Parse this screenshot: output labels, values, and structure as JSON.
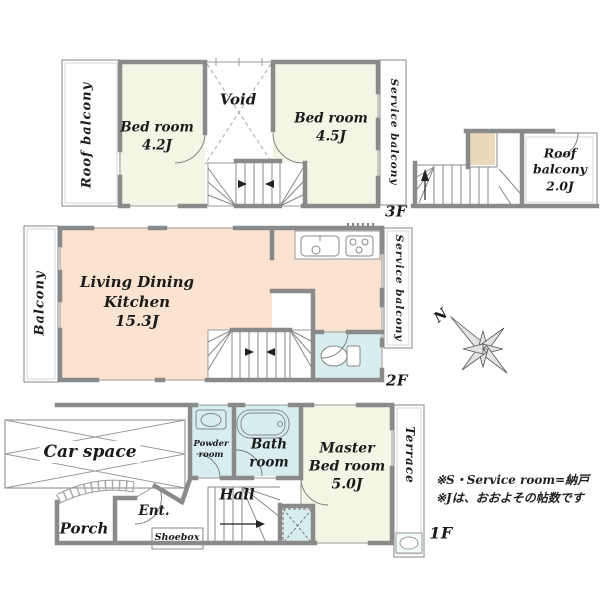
{
  "colors": {
    "wall": "#8a8a8a",
    "thin": "#9a9a9a",
    "stair": "#888888",
    "dash": "#aaaaaa",
    "marks": "#222222",
    "room_ivory": "#f4f6e5",
    "room_peach": "#fae3d0",
    "room_cyan": "#d8edf0",
    "room_tan": "#e9d8ba",
    "white": "#ffffff"
  },
  "floor3": {
    "label": "3F",
    "rooms": {
      "roof_balcony": "Roof balcony",
      "bedroom_a": "Bed room\n4.2J",
      "void": "Void",
      "bedroom_b": "Bed room\n4.5J",
      "service_balcony": "Service balcony",
      "roof_balcony_upper": "Roof\nbalcony\n2.0J"
    }
  },
  "floor2": {
    "label": "2F",
    "compass": "N",
    "rooms": {
      "balcony": "Balcony",
      "ldk": "Living Dining\nKitchen\n15.3J",
      "service_balcony": "Service balcony"
    }
  },
  "floor1": {
    "label": "1F",
    "rooms": {
      "car_space": "Car space",
      "powder_room": "Powder\nroom",
      "bath_room": "Bath\nroom",
      "master_bedroom": "Master\nBed room\n5.0J",
      "hall": "Hall",
      "entrance": "Ent.",
      "shoebox": "Shoebox",
      "porch": "Porch",
      "terrace": "Terrace"
    }
  },
  "notes": {
    "line1": "※S・Service room=納戸",
    "line2": "※Jは、おおよその帖数です"
  }
}
